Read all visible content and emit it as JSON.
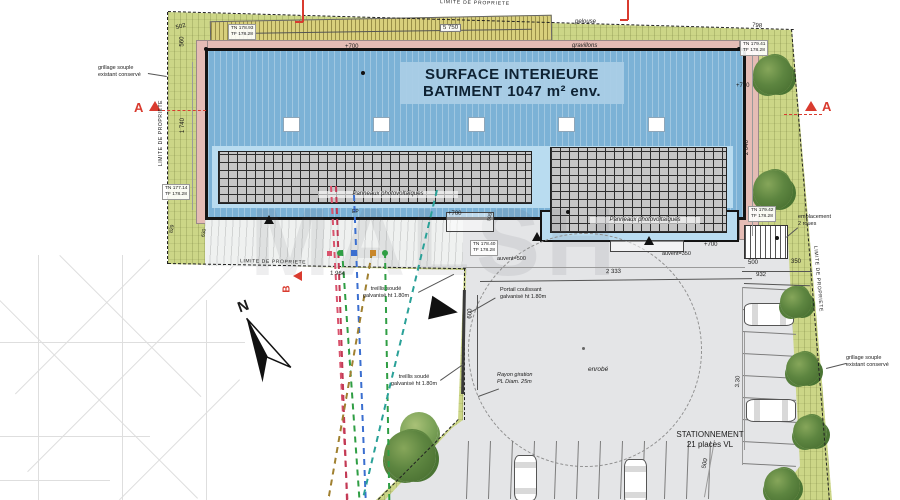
{
  "colors": {
    "site_green": "#ccd687",
    "gravel_khaki": "#d8cf7c",
    "band_pink": "#e5bcb5",
    "roof_blue": "#7cb2d6",
    "pv_blue": "#b9dcf0",
    "panel_gray": "#c6c6c6",
    "paving_gray": "#e4e5e7",
    "marker_red": "#d93b2f",
    "tree_green": "#4e7a33"
  },
  "watermark": "MALSH",
  "boundary_label": "LIMITE DE PROPRIETE",
  "building": {
    "title_line1": "SURFACE INTERIEURE",
    "title_line2": "BATIMENT 1047 m² env.",
    "pv_label": "Panneaux photovoltaïques"
  },
  "surfaces": {
    "lawn": "pelouse",
    "gravel": "gravillons",
    "asphalt": "enrobé"
  },
  "levels": {
    "top_left": {
      "tn": "TN 178.93",
      "tf": "TF 178.28"
    },
    "top_right": {
      "tn": "TN 179.41",
      "tf": "TF 178.28"
    },
    "mid_left": {
      "tn": "TN 177.14",
      "tf": "TF 178.28"
    },
    "mid_right": {
      "tn": "TN 179.42",
      "tf": "TF 178.28"
    },
    "south": {
      "tn": "TN 178.40",
      "tf": "TF 178.28"
    }
  },
  "dimensions": {
    "d502": "502",
    "d560": "560",
    "d5750": "5 750",
    "d798": "798",
    "d1740": "1 740",
    "d2040": "2 040",
    "plus700": "+700",
    "d2333": "2 333",
    "d1964": "1 964",
    "d932": "932",
    "d600": "600",
    "d500": "500",
    "d350": "350",
    "d330": "3.30",
    "d829": "829",
    "d630": "630"
  },
  "annotations": {
    "grillage_l1": "grillage souple",
    "grillage_l2": "existant conservé",
    "treillis_l1": "treillis soudé",
    "treillis_l2": "galvanisé ht 1.80m",
    "portail_l1": "Portail coulissant",
    "portail_l2": "galvanisé ht 1.80m",
    "rayon_l1": "Rayon giration",
    "rayon_l2": "PL Diam. 25m",
    "empl_l1": "emplacement",
    "empl_l2": "2 roues",
    "auvent500": "auvent=500",
    "auvent350": "auvent=350",
    "ep": "EP"
  },
  "parking": {
    "line1": "STATIONNEMENT",
    "line2": "21 places VL"
  },
  "north_label": "N",
  "section_a": "A",
  "section_b": "B"
}
